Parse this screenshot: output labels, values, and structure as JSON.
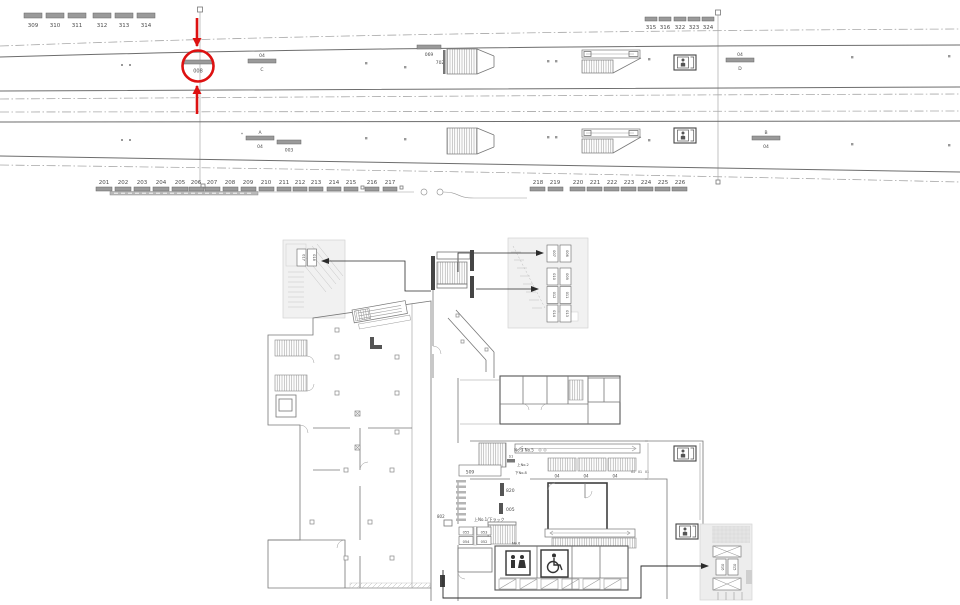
{
  "annotation": {
    "highlight_label": "008",
    "highlight_color": "#dd1111"
  },
  "track": {
    "left_group1": [
      "309",
      "310",
      "311"
    ],
    "left_group2": [
      "312",
      "313",
      "314"
    ],
    "right_group": [
      "315",
      "316",
      "322",
      "323",
      "324"
    ],
    "p1_sign_c_top": "04",
    "p1_sign_c": "C",
    "p1_sign_069": "069",
    "p1_sign_702": "702",
    "p1_sign_d_top": "04",
    "p1_sign_d": "D",
    "p2_sign_a_mark": "*",
    "p2_sign_a": "A",
    "p2_sign_a_num": "04",
    "p2_sign_003": "003",
    "p2_sign_b": "B",
    "p2_sign_b_num": "04",
    "row1": [
      "201",
      "202",
      "203",
      "204",
      "205",
      "206"
    ],
    "row2": [
      "207",
      "208",
      "209",
      "210"
    ],
    "row3": [
      "211",
      "212",
      "213"
    ],
    "row4": [
      "214",
      "215"
    ],
    "row5": [
      "216",
      "217"
    ],
    "row6": [
      "218",
      "219"
    ],
    "row7": [
      "220",
      "221",
      "222",
      "223",
      "224",
      "225",
      "226"
    ]
  },
  "plan": {
    "inset_left": {
      "a": "017",
      "b": "018"
    },
    "inset_right": {
      "r1a": "007",
      "r1b": "006",
      "r2a": "010",
      "r2b": "009",
      "r3a": "012",
      "r3b": "011",
      "r4a": "014",
      "r4b": "013"
    },
    "inset_bottom": {
      "a": "016",
      "b": "015"
    },
    "labels": {
      "no3no5": "No.3 No.5",
      "s1": "S1",
      "up_no2": "上No.2",
      "down_no8": "下No.8",
      "l509": "509",
      "l820": "820",
      "l005": "005",
      "l802": "802",
      "rack": "上No.1/下ラック",
      "l055": "055",
      "l053": "053",
      "l054": "054",
      "l052": "052",
      "no6": "No.6",
      "g04a": "04",
      "g04b": "04",
      "g04c": "04",
      "g01a": "01",
      "g01b": "01",
      "g01c": "01"
    }
  }
}
